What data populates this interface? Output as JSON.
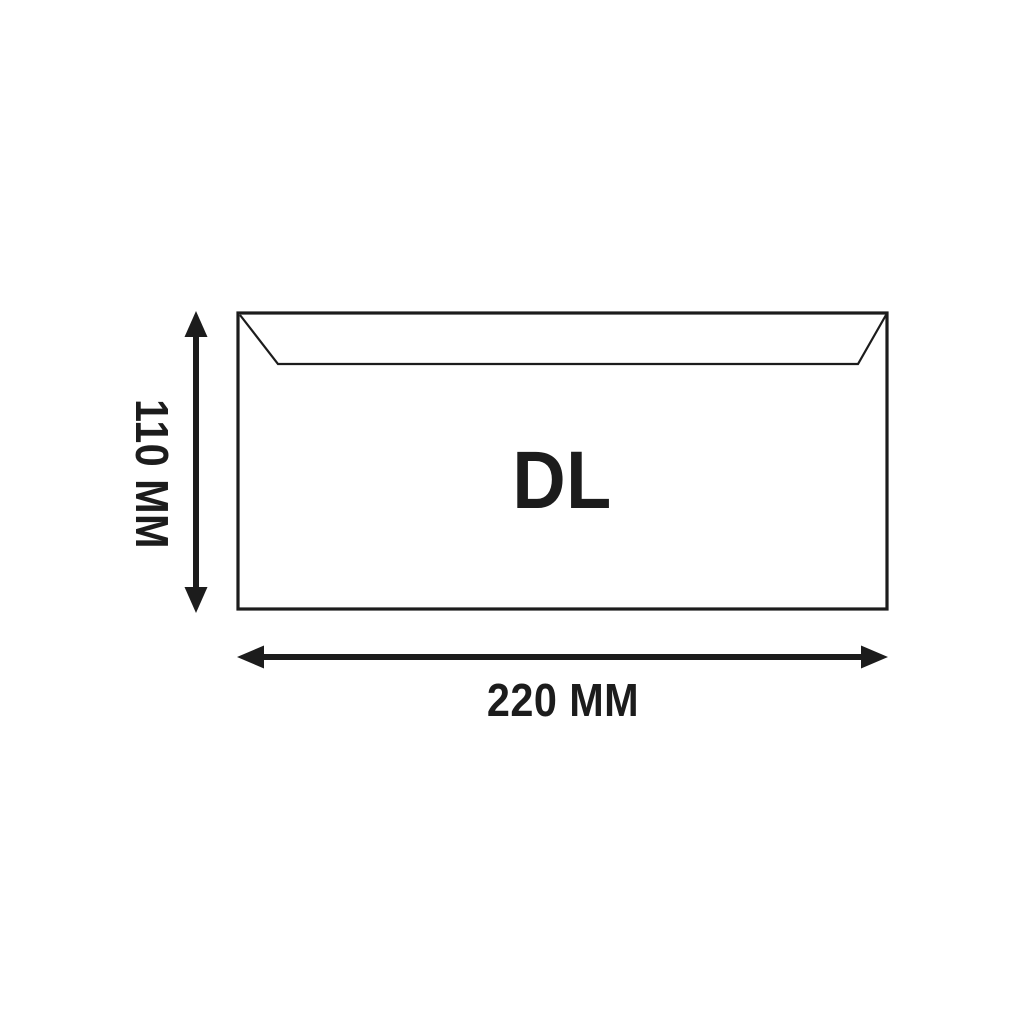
{
  "figure": {
    "type": "envelope-dimension-diagram",
    "background_color": "#ffffff",
    "ink_color": "#1c1c1c",
    "envelope": {
      "size_label": "DL",
      "height_label": "110 MM",
      "width_label": "220 MM"
    }
  }
}
